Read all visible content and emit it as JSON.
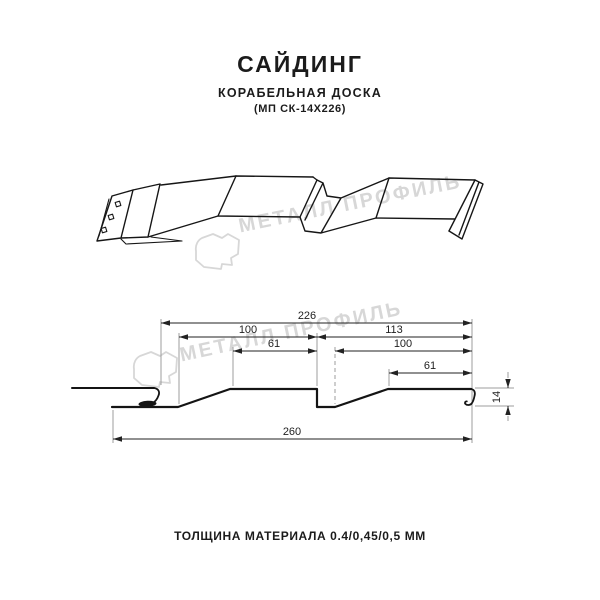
{
  "header": {
    "title": "САЙДИНГ",
    "subtitle": "КОРАБЕЛЬНАЯ ДОСКА",
    "model": "(МП СК-14Х226)"
  },
  "watermark": {
    "text": "МЕТАЛЛ ПРОФИЛЬ",
    "color": "#d7d7d7"
  },
  "cross_section": {
    "dimensions": {
      "overall_top": "226",
      "left_panel": "100",
      "right_panel": "113",
      "left_flat": "61",
      "right_inner": "100",
      "right_flat": "61",
      "total_width": "260",
      "height": "14"
    }
  },
  "footer": {
    "thickness": "ТОЛЩИНА МАТЕРИАЛА 0.4/0,45/0,5 ММ"
  }
}
